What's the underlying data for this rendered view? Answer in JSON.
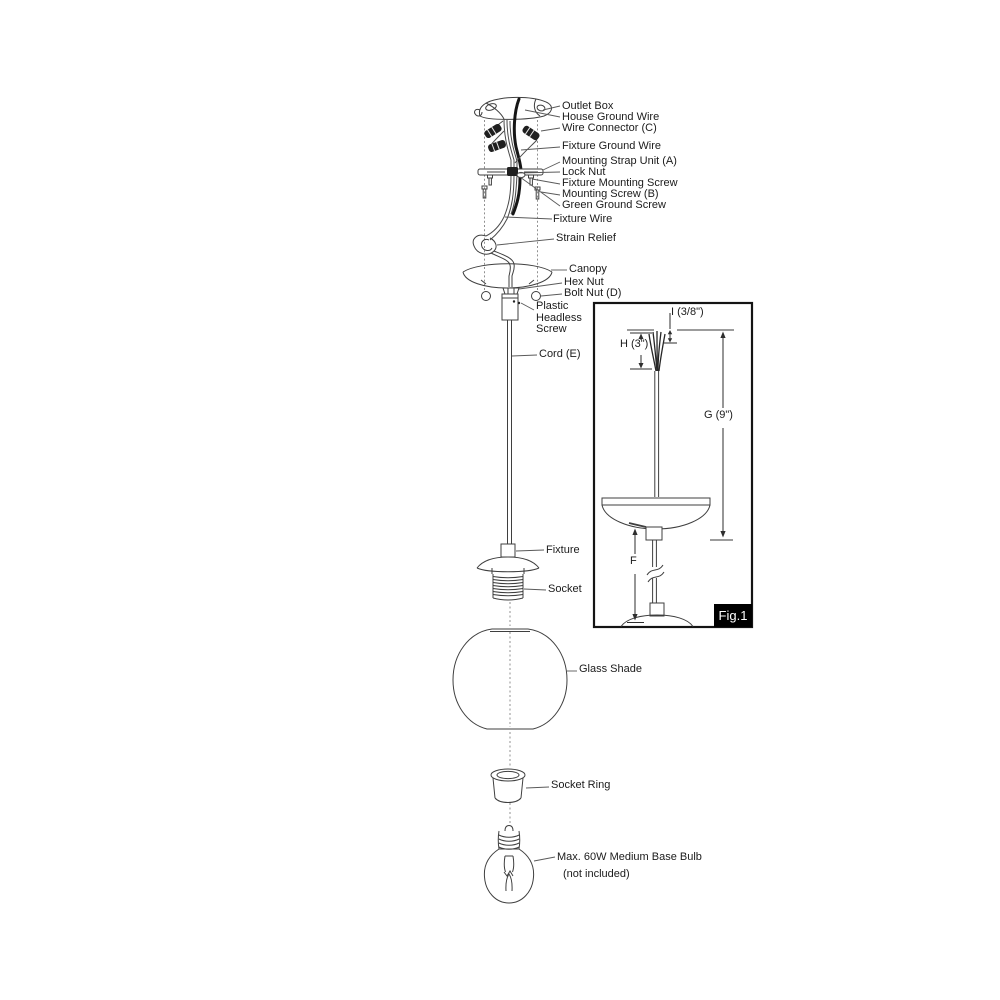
{
  "title": "Pendant Light Fixture Assembly Diagram",
  "labels": {
    "outlet_box": "Outlet Box",
    "house_ground_wire": "House Ground Wire",
    "wire_connector_c": "Wire Connector (C)",
    "fixture_ground_wire": "Fixture Ground Wire",
    "mounting_strap_unit_a": "Mounting Strap Unit (A)",
    "lock_nut": "Lock Nut",
    "fixture_mounting_screw": "Fixture Mounting Screw",
    "mounting_screw_b": "Mounting Screw (B)",
    "green_ground_screw": "Green Ground Screw",
    "fixture_wire": "Fixture Wire",
    "strain_relief": "Strain Relief",
    "canopy": "Canopy",
    "hex_nut": "Hex Nut",
    "bolt_nut_d": "Bolt Nut (D)",
    "plastic_headless_screw": "Plastic\nHeadless\nScrew",
    "cord_e": "Cord (E)",
    "fixture": "Fixture",
    "socket": "Socket",
    "glass_shade": "Glass Shade",
    "socket_ring": "Socket Ring",
    "bulb_line1": "Max. 60W Medium Base Bulb",
    "bulb_line2": "(not included)"
  },
  "inset": {
    "dim_i": "I (3/8\")",
    "dim_h": "H (3\")",
    "dim_g": "G (9\")",
    "dim_f": "F",
    "figure_label": "Fig.1"
  },
  "colors": {
    "line": "#3f3f3f",
    "wire": "#161616",
    "reference_line": "#9c9c9c",
    "leader": "#5a5a5a",
    "figure_badge_bg": "#000000",
    "figure_badge_text": "#ffffff",
    "background": "#ffffff"
  }
}
